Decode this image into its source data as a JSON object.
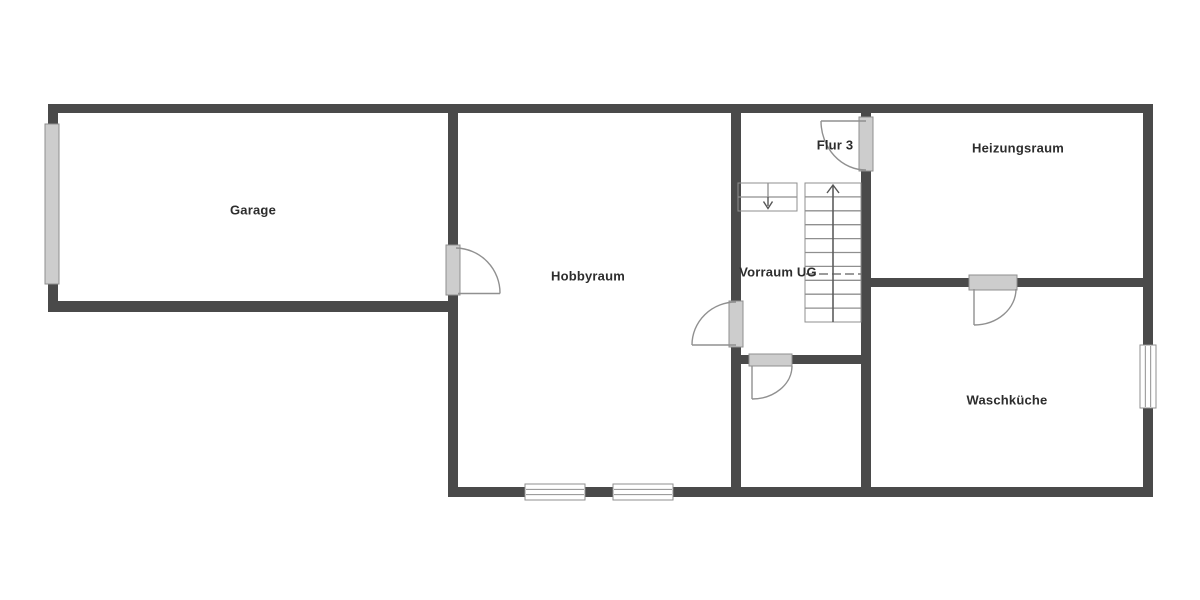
{
  "page": {
    "background": "#ffffff",
    "width": 1200,
    "height": 600
  },
  "colors": {
    "wall": "#4a4a4a",
    "panel_fill": "#cdcdcd",
    "panel_border": "#8f8f8f",
    "window_fill": "#ffffff",
    "window_border": "#8f8f8f",
    "thin_line": "#909090",
    "stair_line": "#8f8f8f",
    "cut_line": "#7a7a7a",
    "arrow": "#555555",
    "text": "#2d2d2d"
  },
  "rooms": [
    {
      "id": "garage",
      "label": "Garage",
      "cx": 253,
      "cy": 210
    },
    {
      "id": "hobbyraum",
      "label": "Hobbyraum",
      "cx": 588,
      "cy": 276
    },
    {
      "id": "flur-3",
      "label": "Flur 3",
      "cx": 835,
      "cy": 145
    },
    {
      "id": "vorraum-ug",
      "label": "Vorraum UG",
      "cx": 778,
      "cy": 272
    },
    {
      "id": "heizungsraum",
      "label": "Heizungsraum",
      "cx": 1018,
      "cy": 148
    },
    {
      "id": "waschkueche",
      "label": "Waschküche",
      "cx": 1007,
      "cy": 400
    }
  ],
  "plan": {
    "walls": [
      {
        "name": "top-exterior-wall",
        "x": 48,
        "y": 104,
        "w": 1105,
        "h": 9
      },
      {
        "name": "garage-left-wall",
        "x": 48,
        "y": 104,
        "w": 10,
        "h": 208
      },
      {
        "name": "garage-bottom-wall",
        "x": 48,
        "y": 301,
        "w": 410,
        "h": 11
      },
      {
        "name": "hobbyraum-left-wall",
        "x": 448,
        "y": 104,
        "w": 10,
        "h": 393
      },
      {
        "name": "bottom-exterior-wall",
        "x": 448,
        "y": 487,
        "w": 705,
        "h": 10
      },
      {
        "name": "right-exterior-wall",
        "x": 1143,
        "y": 104,
        "w": 10,
        "h": 393
      },
      {
        "name": "vorraum-left-wall",
        "x": 731,
        "y": 113,
        "w": 10,
        "h": 374
      },
      {
        "name": "flur-right-wall",
        "x": 861,
        "y": 113,
        "w": 10,
        "h": 374
      },
      {
        "name": "vorraum-bottom-wall",
        "x": 741,
        "y": 355,
        "w": 120,
        "h": 9
      },
      {
        "name": "heizungsraum-bottom-wall",
        "x": 861,
        "y": 278,
        "w": 282,
        "h": 9
      }
    ],
    "panels": [
      {
        "name": "garage-door-panel",
        "x": 45,
        "y": 124,
        "w": 14,
        "h": 160
      },
      {
        "name": "garage-hobbyraum-door-panel",
        "x": 446,
        "y": 245,
        "w": 14,
        "h": 50
      },
      {
        "name": "flur3-door-panel",
        "x": 859,
        "y": 117,
        "w": 14,
        "h": 54
      },
      {
        "name": "hobbyraum-vorraum-door-panel",
        "x": 729,
        "y": 301,
        "w": 14,
        "h": 46
      },
      {
        "name": "vorraum-room-door-panel",
        "x": 749,
        "y": 354,
        "w": 43,
        "h": 12
      },
      {
        "name": "heizung-wasch-door-panel",
        "x": 969,
        "y": 275,
        "w": 48,
        "h": 15
      }
    ],
    "windows": [
      {
        "name": "bottom-window-1",
        "x": 525,
        "y": 484,
        "w": 60,
        "h": 16,
        "dir": "h"
      },
      {
        "name": "bottom-window-2",
        "x": 613,
        "y": 484,
        "w": 60,
        "h": 16,
        "dir": "h"
      },
      {
        "name": "right-window",
        "x": 1140,
        "y": 345,
        "w": 16,
        "h": 63,
        "dir": "v"
      }
    ],
    "door_leaves": [
      {
        "name": "garage-hobbyraum-door-leaf",
        "x1": 458,
        "y1": 293.5,
        "x2": 500,
        "y2": 293.5
      },
      {
        "name": "flur3-door-leaf",
        "x1": 866,
        "y1": 121,
        "x2": 821,
        "y2": 121
      },
      {
        "name": "hobbyraum-vorraum-door-leaf",
        "x1": 736,
        "y1": 345,
        "x2": 692,
        "y2": 345
      },
      {
        "name": "vorraum-room-door-leaf",
        "x1": 752,
        "y1": 366,
        "x2": 752,
        "y2": 399
      },
      {
        "name": "heizung-wasch-door-leaf",
        "x1": 974,
        "y1": 289,
        "x2": 974,
        "y2": 325
      }
    ],
    "door_arcs": [
      {
        "name": "garage-hobbyraum-door-arc",
        "d": "M 456 248 A 45 45 0 0 1 500 293.5"
      },
      {
        "name": "flur3-door-arc",
        "d": "M 821 121 A 45 49 0 0 0 866 170"
      },
      {
        "name": "hobbyraum-vorraum-door-arc",
        "d": "M 736 302 A 44 43 0 0 0 692 345"
      },
      {
        "name": "vorraum-room-door-arc",
        "d": "M 752 399 A 40 33 0 0 0 792 366"
      },
      {
        "name": "heizung-wasch-door-arc",
        "d": "M 974 325 A 42 36 0 0 0 1016 289"
      }
    ],
    "stairs": {
      "rects": [
        {
          "name": "stair-main-flight",
          "x": 805,
          "y": 183,
          "w": 56,
          "h": 139
        },
        {
          "name": "stair-upper-flight",
          "x": 738,
          "y": 183,
          "w": 59,
          "h": 28
        }
      ],
      "lines": [
        {
          "x1": 805,
          "y1": 196.9,
          "x2": 861,
          "y2": 196.9
        },
        {
          "x1": 805,
          "y1": 210.8,
          "x2": 861,
          "y2": 210.8
        },
        {
          "x1": 805,
          "y1": 224.7,
          "x2": 861,
          "y2": 224.7
        },
        {
          "x1": 805,
          "y1": 238.6,
          "x2": 861,
          "y2": 238.6
        },
        {
          "x1": 805,
          "y1": 252.5,
          "x2": 861,
          "y2": 252.5
        },
        {
          "x1": 805,
          "y1": 266.4,
          "x2": 861,
          "y2": 266.4
        },
        {
          "x1": 805,
          "y1": 280.3,
          "x2": 861,
          "y2": 280.3
        },
        {
          "x1": 805,
          "y1": 294.2,
          "x2": 861,
          "y2": 294.2
        },
        {
          "x1": 805,
          "y1": 308.1,
          "x2": 861,
          "y2": 308.1
        },
        {
          "x1": 833,
          "y1": 186,
          "x2": 833,
          "y2": 322
        },
        {
          "x1": 738,
          "y1": 197,
          "x2": 797,
          "y2": 197
        },
        {
          "x1": 768,
          "y1": 183,
          "x2": 768,
          "y2": 197
        }
      ],
      "dashed_lines": [
        {
          "x1": 806,
          "y1": 274,
          "x2": 861,
          "y2": 274,
          "dash": "9 4"
        }
      ]
    },
    "arrows": [
      {
        "name": "stairs-up-arrow",
        "shaft": {
          "x1": 833,
          "y1": 322,
          "x2": 833,
          "y2": 186
        },
        "head": "827,193 833,185 839,193"
      },
      {
        "name": "stairs-down-arrow",
        "shaft": {
          "x1": 768,
          "y1": 197,
          "x2": 768,
          "y2": 206
        },
        "head": "763.5,201.5 768,208.5 772.5,201.5"
      }
    ]
  }
}
